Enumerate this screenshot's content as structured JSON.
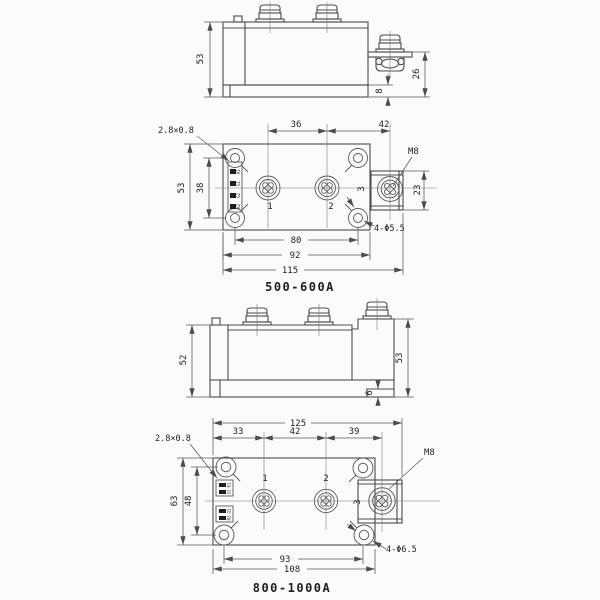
{
  "colors": {
    "background": "#fbfbfb",
    "line": "#4c4c4c",
    "text": "#1e1e1e"
  },
  "views": {
    "side_a": {
      "height": "53",
      "terminal_height": "26",
      "base_thickness": "8"
    },
    "top_a": {
      "caption": "500-600A",
      "tab_size": "2.8×0.8",
      "pitch_12": "36",
      "pitch_23": "42",
      "thread": "M8",
      "body_height": "53",
      "hole_span_v": "38",
      "block_span": "23",
      "terminal_1": "1",
      "terminal_2": "2",
      "terminal_3": "3",
      "mounting_holes": "4-Φ5.5",
      "hole_span_h": "80",
      "body_width": "92",
      "overall_width": "115",
      "control_tabs": [
        "K1",
        "G1",
        "G2",
        "K2"
      ]
    },
    "side_b": {
      "height_left": "52",
      "height_right": "53",
      "foot": "6"
    },
    "top_b": {
      "caption": "800-1000A",
      "tab_size": "2.8×0.8",
      "overall_width": "125",
      "offset_1": "33",
      "pitch_12": "42",
      "pitch_23": "39",
      "thread": "M8",
      "body_height": "63",
      "hole_span_v": "48",
      "terminal_1": "1",
      "terminal_2": "2",
      "terminal_3": "3",
      "mounting_holes": "4-Φ6.5",
      "hole_span_h": "93",
      "body_width": "108",
      "control_tabs_top": [
        "K1",
        "G1"
      ],
      "control_tabs_bottom": [
        "G2",
        "K2"
      ]
    }
  }
}
